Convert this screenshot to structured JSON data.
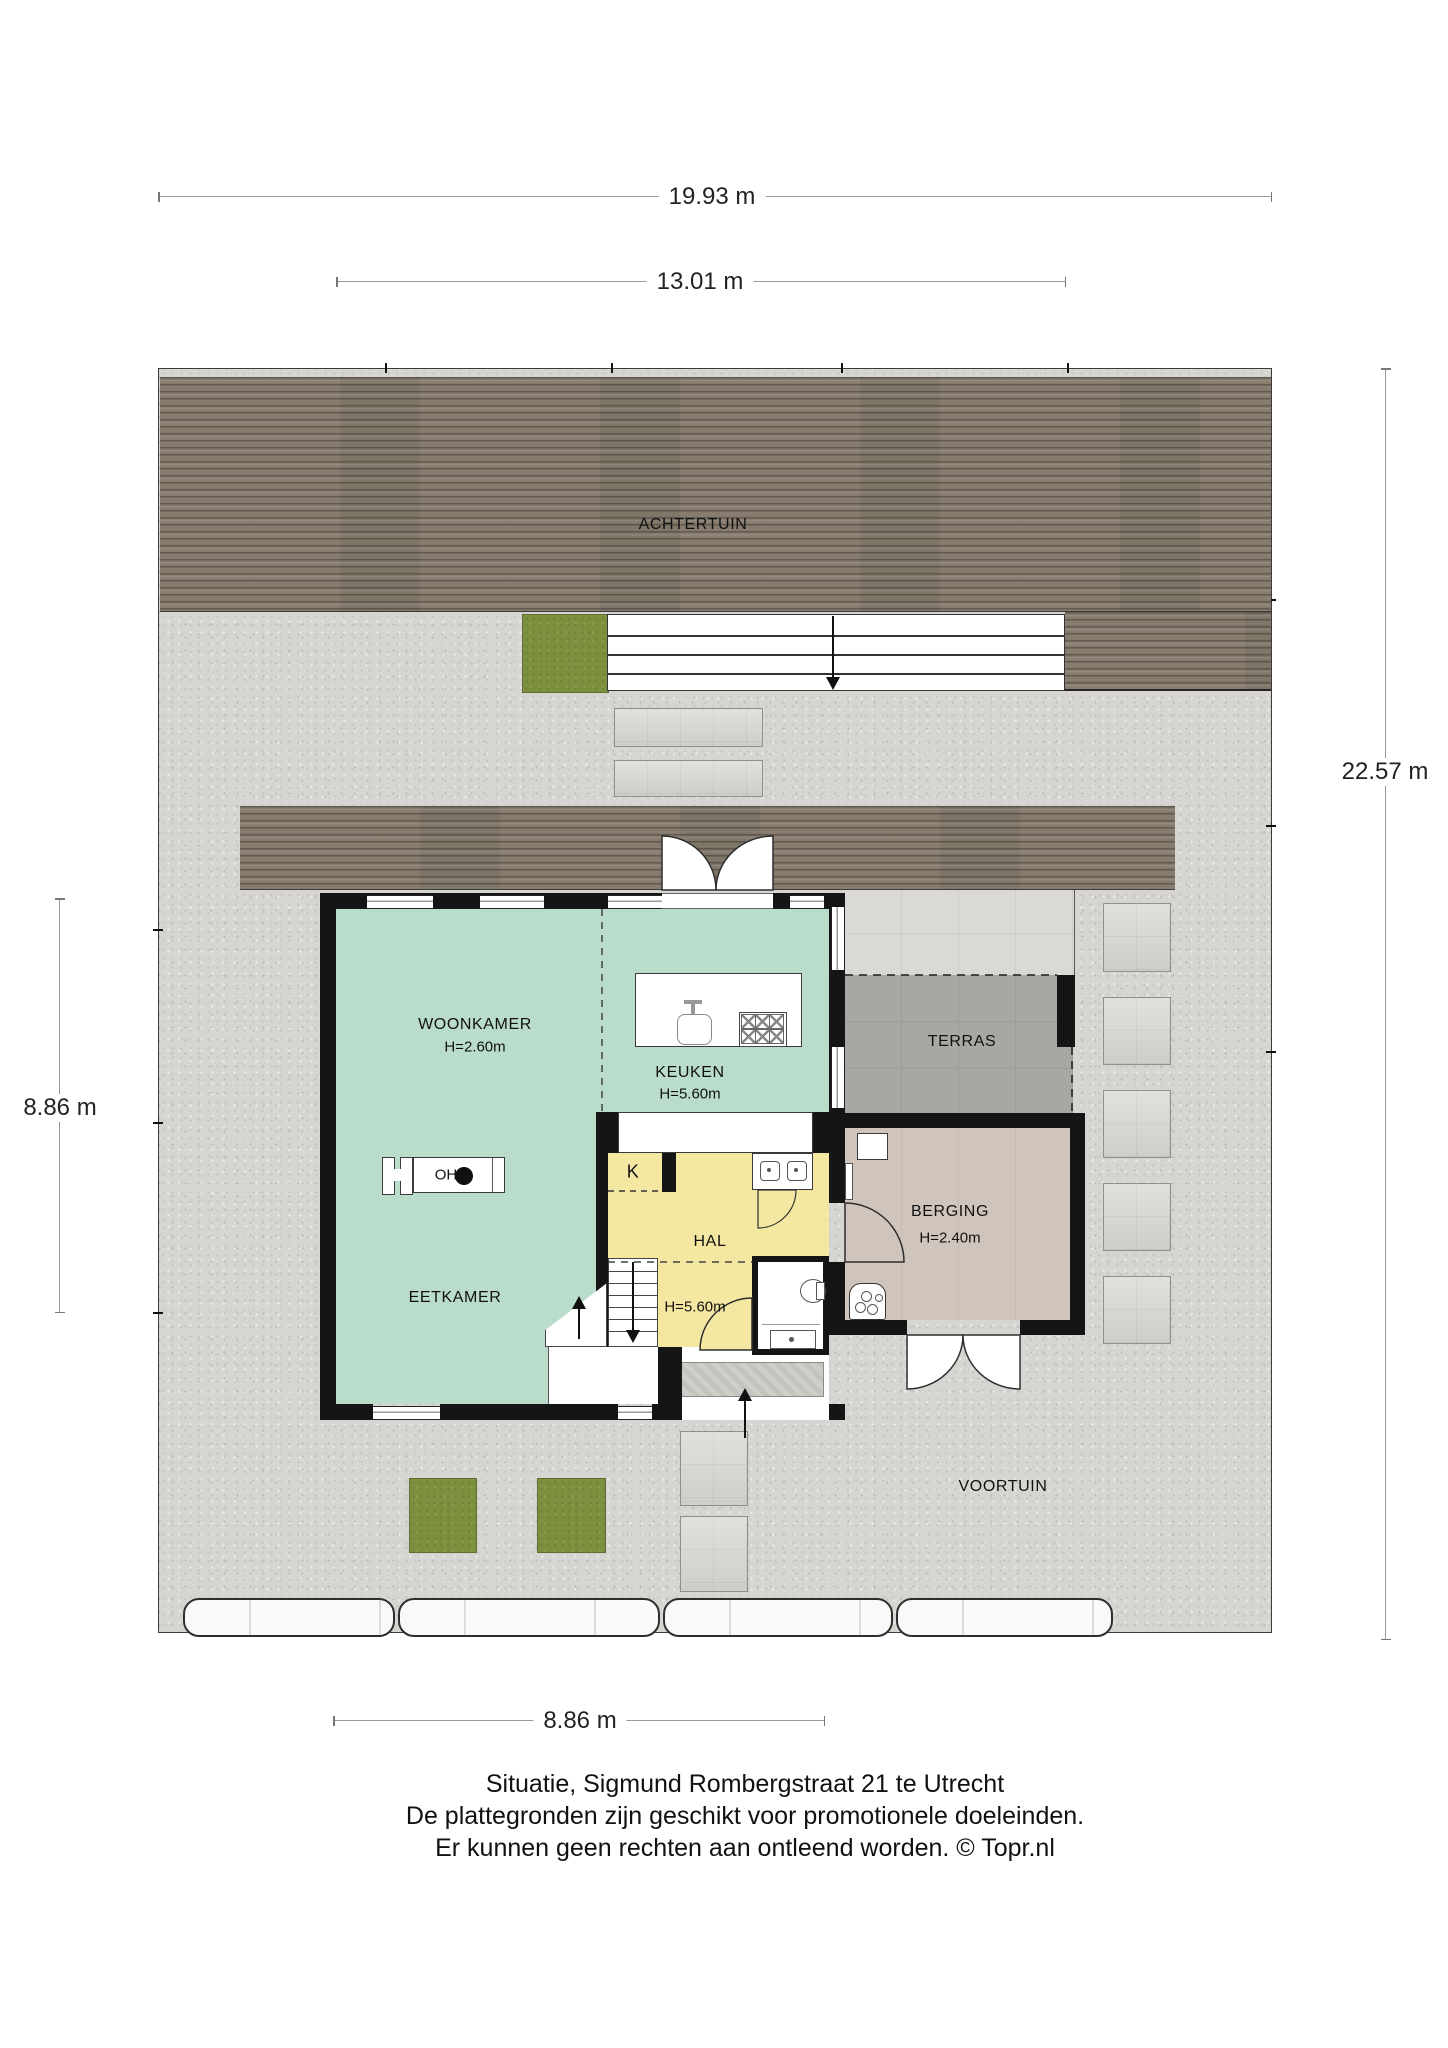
{
  "dimensions": {
    "plot_width_top": "19.93 m",
    "house_width_top": "13.01 m",
    "plot_depth_right": "22.57 m",
    "house_depth_left": "8.86 m",
    "house_width_bottom": "8.86 m"
  },
  "areas": {
    "back_garden": "ACHTERTUIN",
    "front_garden": "VOORTUIN",
    "terrace": "TERRAS"
  },
  "rooms": {
    "woonkamer": {
      "name": "WOONKAMER",
      "ceiling": "H=2.60m"
    },
    "keuken": {
      "name": "KEUKEN",
      "ceiling": "H=5.60m"
    },
    "eetkamer": {
      "name": "EETKAMER"
    },
    "hal": {
      "name": "HAL",
      "ceiling": "H=5.60m"
    },
    "berging": {
      "name": "BERGING",
      "ceiling": "H=2.40m"
    },
    "kast": {
      "name": "K"
    },
    "fireplace": {
      "label": "OH"
    }
  },
  "caption": {
    "line1": "Situatie, Sigmund Rombergstraat 21 te Utrecht",
    "line2": "De plattegronden zijn geschikt voor promotionele doeleinden.",
    "line3": "Er kunnen geen rechten aan ontleend worden. © Topr.nl"
  },
  "colors": {
    "deck_wood": "#877c6e",
    "gravel": "#d6d5d2",
    "grass": "#7d9040",
    "living_floor": "#badccb",
    "hall_floor": "#f4e7a1",
    "storage_floor": "#cfc5bc",
    "terrace_floor": "#a9a7a3",
    "covered_terrace_floor": "#dad9d6",
    "paving_slab": "#d7d6d3",
    "wall": "#151515"
  }
}
